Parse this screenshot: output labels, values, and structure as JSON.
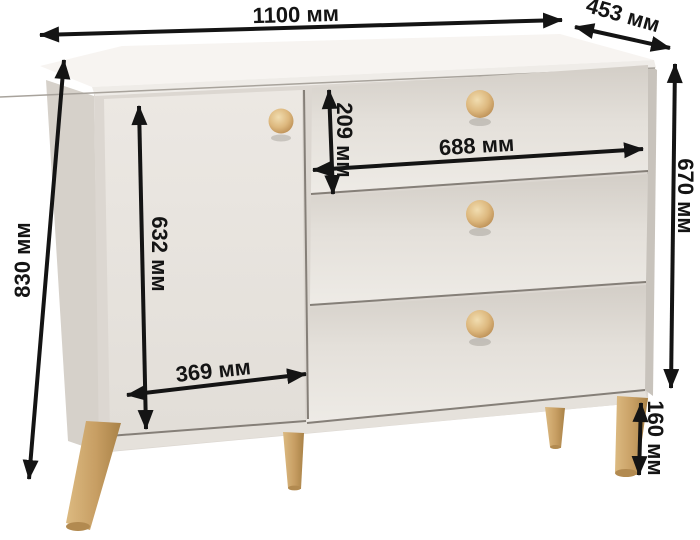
{
  "diagram": {
    "kind": "furniture-dimensions-diagram",
    "unit_suffix": "мм"
  },
  "dimensions": {
    "overall_width_label": "1100 мм",
    "depth_label": "453 мм",
    "overall_height_label": "830 мм",
    "body_height_label": "670 мм",
    "top_drawer_height_label": "209 мм",
    "drawers_width_label": "688 мм",
    "door_height_label": "632 мм",
    "door_width_label": "369 мм",
    "legs_height_label": "160 мм"
  },
  "palette": {
    "background": "#ffffff",
    "arrow": "#141414",
    "body": "#e7e3dd",
    "body_top": "#f6f3f0",
    "side_shade": "#d6d1ca",
    "wood": "#d2a96e"
  }
}
